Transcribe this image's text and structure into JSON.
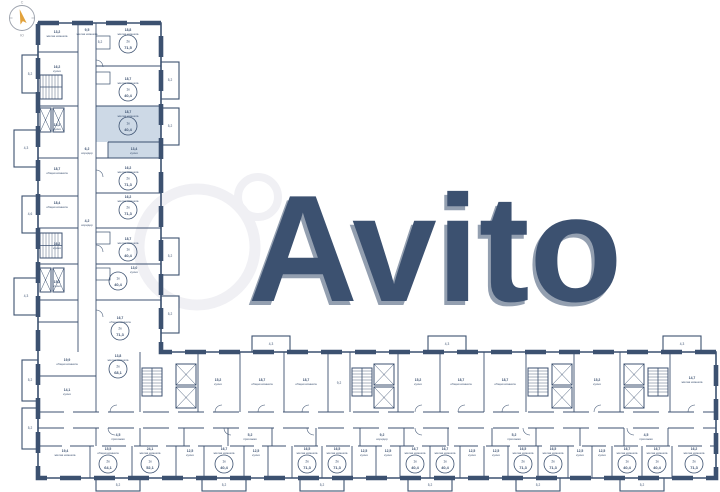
{
  "watermark": {
    "text": "Avito"
  },
  "compass": {
    "north": "С",
    "south": "Ю"
  },
  "palette": {
    "wall": "#3c5170",
    "highlight": "#cdd9e6",
    "watermark_fill": "#ffffff",
    "watermark_shadow": "#e9e9ee",
    "compass_arrow": "#e2a23b"
  },
  "selected_unit": {
    "type": "1к",
    "area": "40,4"
  },
  "room_labels": [
    {
      "x": 57,
      "y": 33,
      "a": "13,2",
      "n": "жилая комната"
    },
    {
      "x": 87,
      "y": 31,
      "a": "9,5",
      "n": "жилая комната"
    },
    {
      "x": 128,
      "y": 31,
      "a": "18,8",
      "n": "жилая комната"
    },
    {
      "x": 57,
      "y": 68,
      "a": "16,2",
      "n": "кухня"
    },
    {
      "x": 128,
      "y": 80,
      "a": "18,7",
      "n": "жилая комната"
    },
    {
      "x": 57,
      "y": 126,
      "a": "15,2",
      "n": "кухня"
    },
    {
      "x": 128,
      "y": 113,
      "a": "18,7",
      "n": "жилая комната"
    },
    {
      "x": 134,
      "y": 150,
      "a": "13,4",
      "n": "кухня"
    },
    {
      "x": 57,
      "y": 170,
      "a": "18,7",
      "n": "общая комната"
    },
    {
      "x": 128,
      "y": 169,
      "a": "16,2",
      "n": "жилая комната"
    },
    {
      "x": 57,
      "y": 204,
      "a": "18,4",
      "n": "общая комната"
    },
    {
      "x": 128,
      "y": 198,
      "a": "16,2",
      "n": "жилая комната"
    },
    {
      "x": 57,
      "y": 245,
      "a": "16,2",
      "n": "кухня"
    },
    {
      "x": 128,
      "y": 240,
      "a": "18,7",
      "n": "жилая комната"
    },
    {
      "x": 134,
      "y": 269,
      "a": "13,0",
      "n": "кухня"
    },
    {
      "x": 57,
      "y": 283,
      "a": "15,2",
      "n": "кухня"
    },
    {
      "x": 120,
      "y": 319,
      "a": "16,7",
      "n": "общая комната"
    },
    {
      "x": 87,
      "y": 150,
      "a": "6,2",
      "n": "коридор"
    },
    {
      "x": 87,
      "y": 222,
      "a": "4,2",
      "n": "коридор"
    },
    {
      "x": 67,
      "y": 361,
      "a": "19,9",
      "n": "общая комната"
    },
    {
      "x": 67,
      "y": 391,
      "a": "14,1",
      "n": "кухня"
    },
    {
      "x": 118,
      "y": 357,
      "a": "13,8",
      "n": "жилая комната"
    },
    {
      "x": 218,
      "y": 381,
      "a": "15,2",
      "n": "кухня"
    },
    {
      "x": 262,
      "y": 381,
      "a": "18,7",
      "n": "общая комната"
    },
    {
      "x": 306,
      "y": 381,
      "a": "18,7",
      "n": "общая комната"
    },
    {
      "x": 418,
      "y": 381,
      "a": "15,2",
      "n": "кухня"
    },
    {
      "x": 461,
      "y": 381,
      "a": "18,7",
      "n": "общая комната"
    },
    {
      "x": 505,
      "y": 381,
      "a": "18,7",
      "n": "общая комната"
    },
    {
      "x": 597,
      "y": 381,
      "a": "15,2",
      "n": "кухня"
    },
    {
      "x": 692,
      "y": 379,
      "a": "14,7",
      "n": "жилая комната"
    },
    {
      "x": 118,
      "y": 436,
      "a": "4,5",
      "n": "прихожая"
    },
    {
      "x": 250,
      "y": 436,
      "a": "5,2",
      "n": "прихожая"
    },
    {
      "x": 382,
      "y": 436,
      "a": "9,2",
      "n": "коридор"
    },
    {
      "x": 514,
      "y": 436,
      "a": "5,2",
      "n": "прихожая"
    },
    {
      "x": 646,
      "y": 436,
      "a": "4,5",
      "n": "прихожая"
    },
    {
      "x": 65,
      "y": 452,
      "a": "19,4",
      "n": "жилая комната"
    },
    {
      "x": 108,
      "y": 450,
      "a": "15,5",
      "n": "общая комната"
    },
    {
      "x": 150,
      "y": 450,
      "a": "24,1",
      "n": "жилая комната"
    },
    {
      "x": 190,
      "y": 452,
      "a": "12,5",
      "n": "кухня"
    },
    {
      "x": 224,
      "y": 450,
      "a": "16,7",
      "n": "жилая комната"
    },
    {
      "x": 256,
      "y": 452,
      "a": "12,5",
      "n": "кухня"
    },
    {
      "x": 307,
      "y": 450,
      "a": "16,5",
      "n": "жилая комната"
    },
    {
      "x": 337,
      "y": 450,
      "a": "16,5",
      "n": "жилая комната"
    },
    {
      "x": 364,
      "y": 452,
      "a": "12,5",
      "n": "кухня"
    },
    {
      "x": 388,
      "y": 452,
      "a": "12,5",
      "n": "кухня"
    },
    {
      "x": 415,
      "y": 450,
      "a": "16,7",
      "n": "жилая комната"
    },
    {
      "x": 445,
      "y": 450,
      "a": "16,7",
      "n": "жилая комната"
    },
    {
      "x": 472,
      "y": 452,
      "a": "12,5",
      "n": "кухня"
    },
    {
      "x": 496,
      "y": 452,
      "a": "12,5",
      "n": "кухня"
    },
    {
      "x": 523,
      "y": 450,
      "a": "16,5",
      "n": "жилая комната"
    },
    {
      "x": 553,
      "y": 450,
      "a": "16,5",
      "n": "жилая комната"
    },
    {
      "x": 580,
      "y": 452,
      "a": "12,5",
      "n": "кухня"
    },
    {
      "x": 602,
      "y": 452,
      "a": "12,5",
      "n": "кухня"
    },
    {
      "x": 627,
      "y": 450,
      "a": "16,7",
      "n": "жилая комната"
    },
    {
      "x": 657,
      "y": 450,
      "a": "16,7",
      "n": "жилая комната"
    },
    {
      "x": 694,
      "y": 450,
      "a": "16,2",
      "n": "жилая комната"
    }
  ],
  "unit_badges": [
    {
      "x": 128,
      "y": 44,
      "t": "2к",
      "a": "71,5",
      "s": false
    },
    {
      "x": 128,
      "y": 92,
      "t": "1к",
      "a": "40,4",
      "s": false
    },
    {
      "x": 128,
      "y": 126,
      "t": "1к",
      "a": "40,4",
      "s": true
    },
    {
      "x": 128,
      "y": 181,
      "t": "2к",
      "a": "71,3",
      "s": false
    },
    {
      "x": 128,
      "y": 210,
      "t": "2к",
      "a": "71,3",
      "s": false
    },
    {
      "x": 128,
      "y": 252,
      "t": "1к",
      "a": "40,4",
      "s": false
    },
    {
      "x": 118,
      "y": 281,
      "t": "1к",
      "a": "40,4",
      "s": false
    },
    {
      "x": 120,
      "y": 331,
      "t": "2к",
      "a": "71,3",
      "s": false
    },
    {
      "x": 118,
      "y": 369,
      "t": "2к",
      "a": "68,1",
      "s": false
    },
    {
      "x": 108,
      "y": 464,
      "t": "2к",
      "a": "64,1",
      "s": false
    },
    {
      "x": 150,
      "y": 464,
      "t": "1к",
      "a": "52,1",
      "s": false
    },
    {
      "x": 224,
      "y": 464,
      "t": "1к",
      "a": "40,4",
      "s": false
    },
    {
      "x": 307,
      "y": 464,
      "t": "2к",
      "a": "71,3",
      "s": false
    },
    {
      "x": 337,
      "y": 464,
      "t": "2к",
      "a": "71,3",
      "s": false
    },
    {
      "x": 415,
      "y": 464,
      "t": "1к",
      "a": "40,4",
      "s": false
    },
    {
      "x": 445,
      "y": 464,
      "t": "1к",
      "a": "40,4",
      "s": false
    },
    {
      "x": 523,
      "y": 464,
      "t": "2к",
      "a": "71,3",
      "s": false
    },
    {
      "x": 553,
      "y": 464,
      "t": "2к",
      "a": "71,3",
      "s": false
    },
    {
      "x": 627,
      "y": 464,
      "t": "1к",
      "a": "40,4",
      "s": false
    },
    {
      "x": 657,
      "y": 464,
      "t": "1к",
      "a": "40,4",
      "s": false
    },
    {
      "x": 694,
      "y": 464,
      "t": "2к",
      "a": "71,3",
      "s": false
    }
  ],
  "small_areas": [
    {
      "x": 30,
      "y": 75,
      "t": "5,2"
    },
    {
      "x": 26,
      "y": 149,
      "t": "4,3"
    },
    {
      "x": 30,
      "y": 215,
      "t": "4,6"
    },
    {
      "x": 26,
      "y": 297,
      "t": "4,3"
    },
    {
      "x": 170,
      "y": 81,
      "t": "5,2"
    },
    {
      "x": 170,
      "y": 127,
      "t": "5,2"
    },
    {
      "x": 170,
      "y": 257,
      "t": "5,2"
    },
    {
      "x": 170,
      "y": 315,
      "t": "5,2"
    },
    {
      "x": 30,
      "y": 381,
      "t": "5,2"
    },
    {
      "x": 30,
      "y": 429,
      "t": "5,2"
    },
    {
      "x": 271,
      "y": 345,
      "t": "4,3"
    },
    {
      "x": 447,
      "y": 345,
      "t": "4,3"
    },
    {
      "x": 682,
      "y": 345,
      "t": "4,3"
    },
    {
      "x": 118,
      "y": 486,
      "t": "5,2"
    },
    {
      "x": 224,
      "y": 486,
      "t": "5,2"
    },
    {
      "x": 322,
      "y": 486,
      "t": "5,2"
    },
    {
      "x": 430,
      "y": 486,
      "t": "5,2"
    },
    {
      "x": 538,
      "y": 486,
      "t": "5,2"
    },
    {
      "x": 642,
      "y": 486,
      "t": "5,2"
    },
    {
      "x": 339,
      "y": 384,
      "t": "9,2"
    },
    {
      "x": 100,
      "y": 43,
      "t": "5,2"
    }
  ]
}
